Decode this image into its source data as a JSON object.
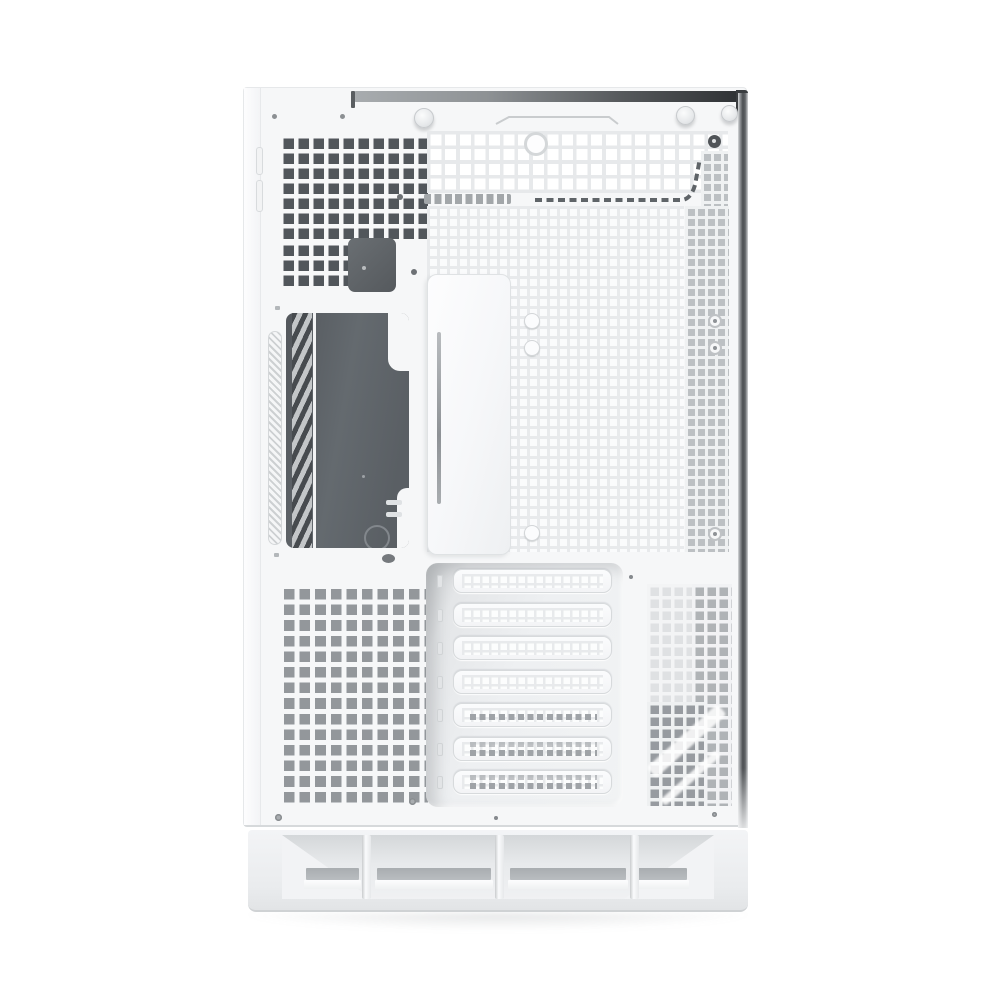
{
  "meta": {
    "type": "product-photo",
    "subject": "White mid-tower PC case, rear/side panel view on white background",
    "background": "#ffffff"
  },
  "colors": {
    "panel": "#f6f7f8",
    "hole-dark": "#51565b",
    "hole-mid": "#93979b",
    "strip-dark": "#3a3d40",
    "window-dark": "#60656a",
    "base-face": "#eef0f2",
    "slot-gray": "#b2b6b9",
    "edge-bar": "#4c4f52",
    "screw-face": "#e7e9eb"
  },
  "features": {
    "top_thumbscrews": 3,
    "top_rivets": 2,
    "fan_mount_holes": 1,
    "standoff_buttons": 3,
    "grommet_rings": 3,
    "expansion_slot_covers": 7,
    "base_vent_sections": 4,
    "vent_grids": [
      "top-left-dark-grid",
      "top-bright-mesh",
      "center-fine-mesh",
      "right-gray-mesh-strip",
      "bottom-left-gray-grid",
      "bottom-right-mesh"
    ]
  },
  "pci": {
    "slot_count": 7,
    "slot_styles": [
      "plain",
      "plain",
      "plain",
      "plain",
      "dots-mid",
      "dots-double",
      "dots-double"
    ]
  },
  "base": {
    "sections": 4,
    "dividers": 3
  }
}
